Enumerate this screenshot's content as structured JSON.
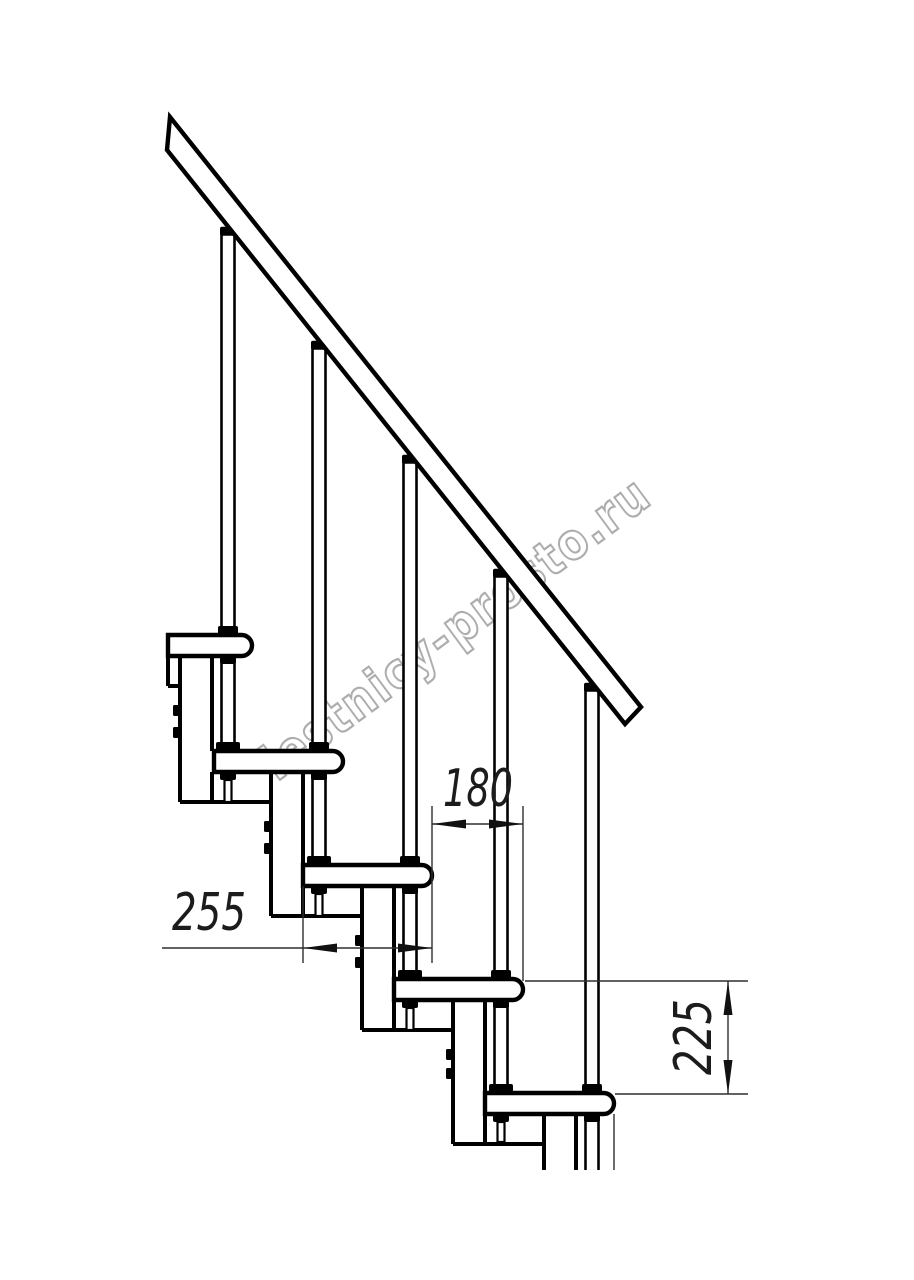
{
  "page": {
    "background": "#ffffff"
  },
  "watermark": {
    "text": "lestnicy-prosto.ru",
    "color": "#adadad"
  },
  "drawing": {
    "line_color": "#000000",
    "dim_line_color": "#2f2f2f",
    "subject_labels": {
      "handrail": "handrail",
      "baluster": "baluster",
      "tread": "tread",
      "support_module": "support-module"
    }
  },
  "dimensions": {
    "step_run": {
      "value": "180"
    },
    "tread_depth": {
      "value": "255"
    },
    "riser_height": {
      "value": "225"
    }
  }
}
